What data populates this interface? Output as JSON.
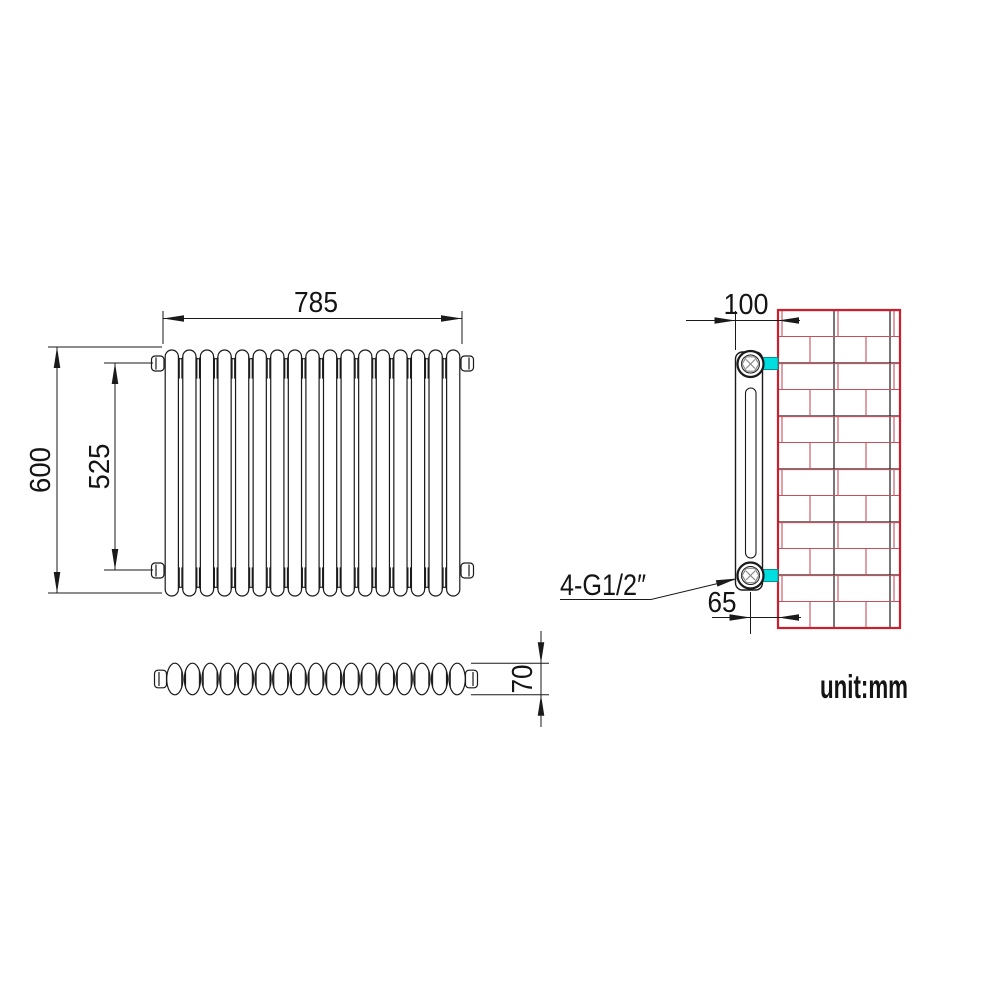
{
  "views": {
    "front": {
      "dim_width": "785",
      "dim_height": "600",
      "dim_connection_span": "525",
      "sections": 17
    },
    "plan": {
      "dim_depth": "70",
      "sections": 17
    },
    "side": {
      "dim_wall_offset": "100",
      "dim_pipe_center_to_wall": "65",
      "connection_label": "4-G1/2″"
    }
  },
  "unit_note": "unit:mm",
  "colors": {
    "line": "#1a1a1a",
    "wall_outline": "#cc1f2e",
    "brick_joint": "#c4515c",
    "bracket": "#00dfdf",
    "bracket_edge": "#0a8f8f",
    "nut_detail": "#8a8a8a"
  }
}
